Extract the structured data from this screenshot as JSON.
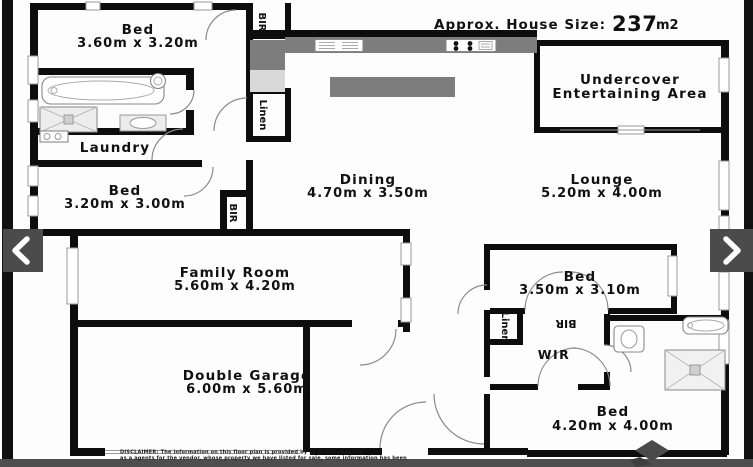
{
  "header": {
    "house_size_label": "Approx. House Size:",
    "house_size_value": "237",
    "house_size_unit": "m2"
  },
  "rooms": {
    "bed1": {
      "name": "Bed",
      "dims": "3.60m x 3.20m"
    },
    "bed2": {
      "name": "Bed",
      "dims": "3.20m x 3.00m"
    },
    "laundry": {
      "name": "Laundry"
    },
    "dining": {
      "name": "Dining",
      "dims": "4.70m x 3.50m"
    },
    "lounge": {
      "name": "Lounge",
      "dims": "5.20m x 4.00m"
    },
    "undercover": {
      "line1": "Undercover",
      "line2": "Entertaining Area"
    },
    "family": {
      "name": "Family Room",
      "dims": "5.60m x 4.20m"
    },
    "garage": {
      "name": "Double Garage",
      "dims": "6.00m x 5.60m"
    },
    "bed3": {
      "name": "Bed",
      "dims": "3.50m x 3.10m"
    },
    "bed4": {
      "name": "Bed",
      "dims": "4.20m x 4.00m"
    },
    "wir": {
      "name": "WIR"
    }
  },
  "closets": {
    "bir_top": "BIR",
    "linen_top": "Linen",
    "bir_bed2": "BIR",
    "bir_bed3": "BIR",
    "linen_bed3": "Linen"
  },
  "disclaimer": {
    "line1": "DISCLAIMER: The information on this floor plan is provided by us in our capacity",
    "line2": "as a agents for the vendor, whose property we have listed for sale, some information has been"
  },
  "icons": {
    "prev": "chevron-left",
    "next": "chevron-right",
    "logo": "diamond-logo"
  },
  "colors": {
    "wall": "#0d0d0d",
    "counter": "#7d7d7d",
    "chrome": "#4b4b4b"
  }
}
